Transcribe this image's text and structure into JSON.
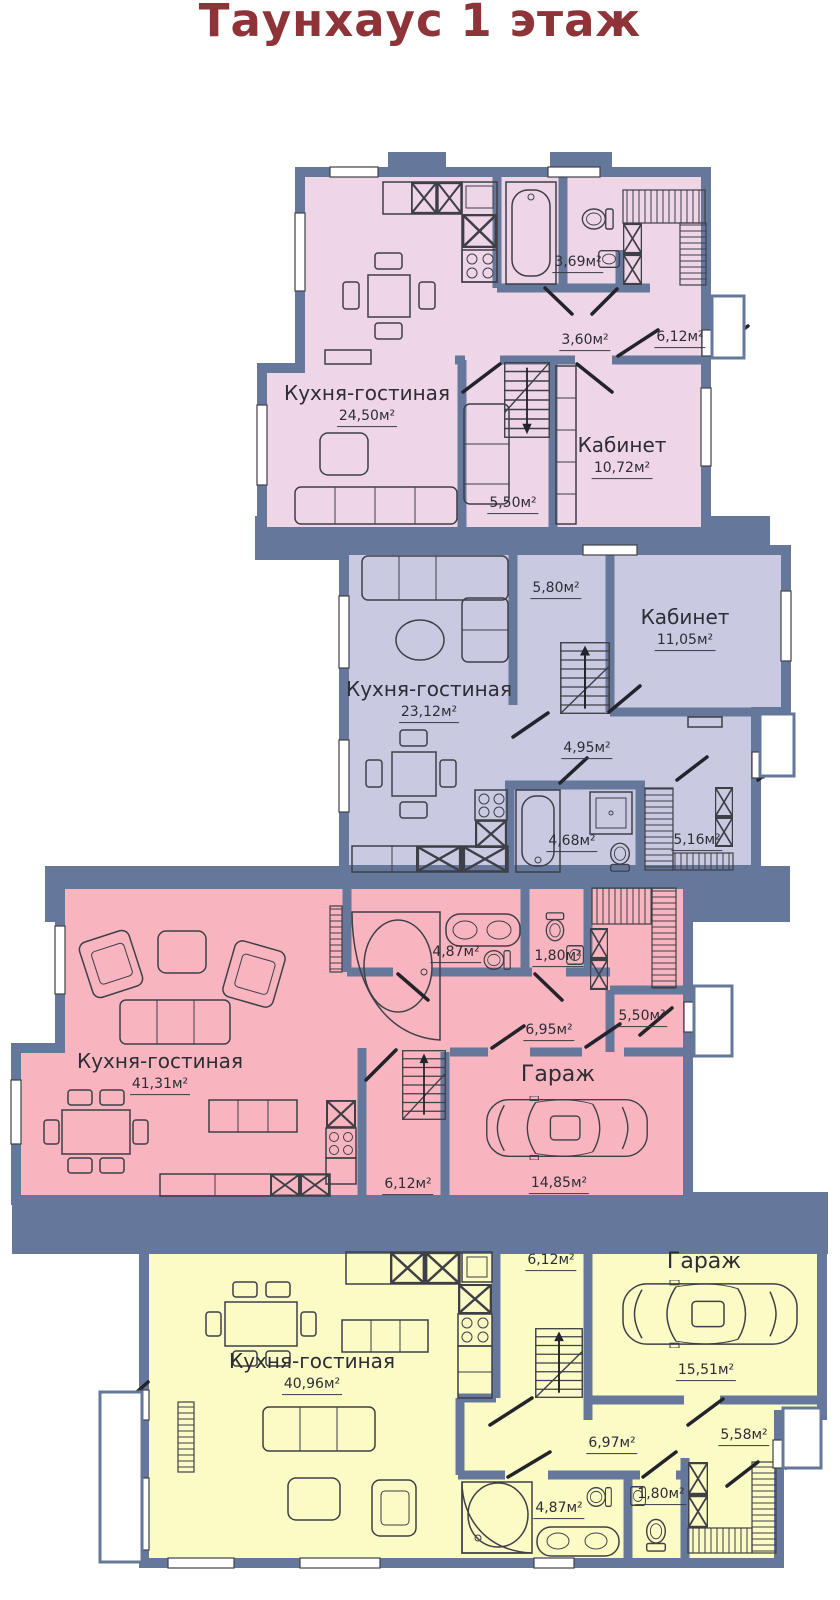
{
  "title": "Таунхаус 1 этаж",
  "colors": {
    "title": "#8e3337",
    "wall": "#65789b",
    "unit1_fill": "#eed6e6",
    "unit2_fill": "#c9cae1",
    "unit3_fill": "#f8b5bf",
    "unit4_fill": "#fbfbc6",
    "line": "#3f3f48"
  },
  "icons": [
    "bathtub-icon",
    "corner-bathtub-icon",
    "toilet-icon",
    "sink-icon",
    "double-sink-icon",
    "shower-icon",
    "stove-icon",
    "kitchen-counter-icon",
    "wardrobe-icon",
    "stairs-icon",
    "car-icon",
    "sofa-icon",
    "armchair-icon",
    "dining-table-icon",
    "coffee-table-icon",
    "round-table-icon",
    "door-swing-icon",
    "window-icon"
  ],
  "units": [
    {
      "id": "unit-1",
      "rooms": [
        {
          "name": "Кухня-гостиная",
          "area": "24,50м²"
        },
        {
          "name": "Кабинет",
          "area": "10,72м²"
        },
        {
          "name": "",
          "area": "3,69м²"
        },
        {
          "name": "",
          "area": "3,60м²"
        },
        {
          "name": "",
          "area": "6,12м²"
        },
        {
          "name": "",
          "area": "5,50м²"
        }
      ]
    },
    {
      "id": "unit-2",
      "rooms": [
        {
          "name": "Кухня-гостиная",
          "area": "23,12м²"
        },
        {
          "name": "Кабинет",
          "area": "11,05м²"
        },
        {
          "name": "",
          "area": "5,80м²"
        },
        {
          "name": "",
          "area": "4,95м²"
        },
        {
          "name": "",
          "area": "4,68м²"
        },
        {
          "name": "",
          "area": "5,16м²"
        }
      ]
    },
    {
      "id": "unit-3",
      "rooms": [
        {
          "name": "Кухня-гостиная",
          "area": "41,31м²"
        },
        {
          "name": "Гараж",
          "area": "14,85м²"
        },
        {
          "name": "",
          "area": "4,87м²"
        },
        {
          "name": "",
          "area": "1,80м²"
        },
        {
          "name": "",
          "area": "6,95м²"
        },
        {
          "name": "",
          "area": "5,50м²"
        },
        {
          "name": "",
          "area": "6,12м²"
        }
      ]
    },
    {
      "id": "unit-4",
      "rooms": [
        {
          "name": "Кухня-гостиная",
          "area": "40,96м²"
        },
        {
          "name": "Гараж",
          "area": "15,51м²"
        },
        {
          "name": "",
          "area": "6,12м²"
        },
        {
          "name": "",
          "area": "6,97м²"
        },
        {
          "name": "",
          "area": "5,58м²"
        },
        {
          "name": "",
          "area": "4,87м²"
        },
        {
          "name": "",
          "area": "1,80м²"
        }
      ]
    }
  ]
}
